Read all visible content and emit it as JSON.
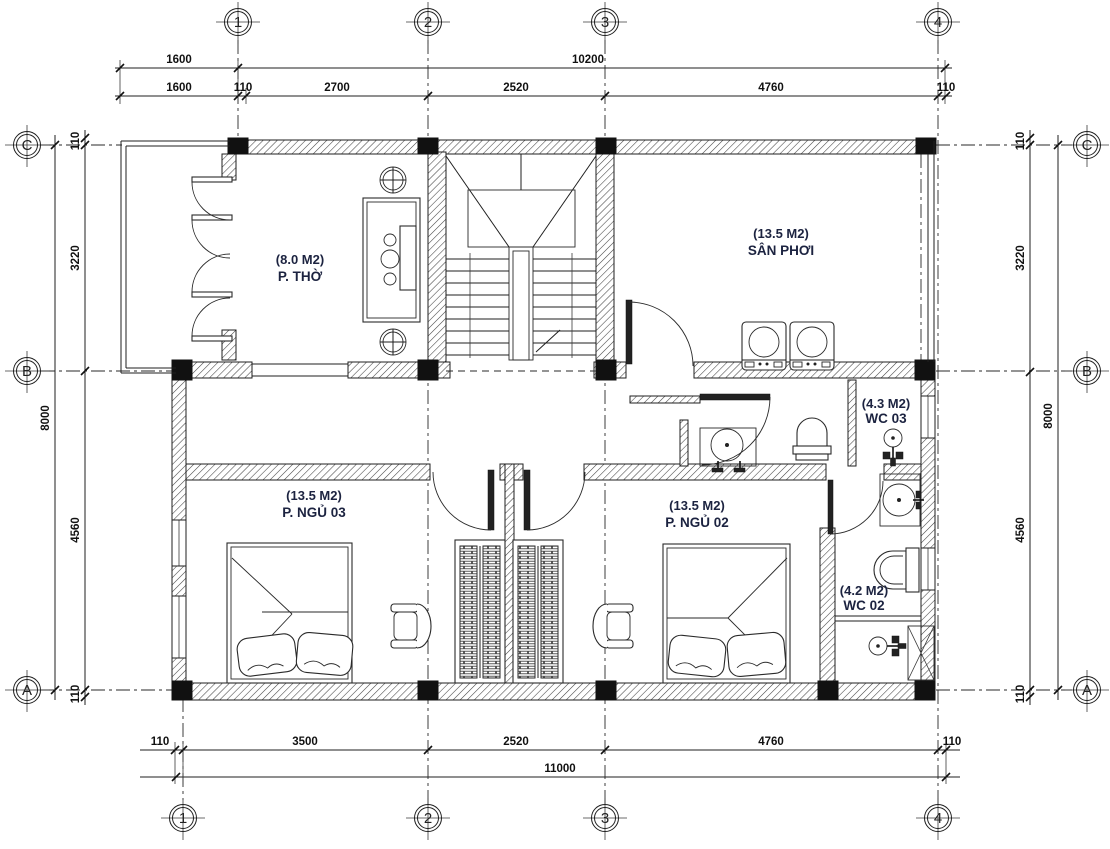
{
  "grid": {
    "top": [
      "1",
      "2",
      "3",
      "4"
    ],
    "bottom": [
      "1",
      "2",
      "3",
      "4"
    ],
    "left": [
      "C",
      "B",
      "A"
    ],
    "right": [
      "C",
      "B",
      "A"
    ]
  },
  "dims": {
    "top1": [
      "1600",
      "10200"
    ],
    "top2": [
      "1600",
      "110",
      "2700",
      "2520",
      "4760",
      "110"
    ],
    "bottom1": [
      "110",
      "3500",
      "2520",
      "4760",
      "110"
    ],
    "bottom2": [
      "11000"
    ],
    "left": [
      "110",
      "3220",
      "8000",
      "4560",
      "110"
    ],
    "right": [
      "110",
      "3220",
      "8000",
      "4560",
      "110"
    ]
  },
  "rooms": [
    {
      "area": "(8.0 M2)",
      "name": "P. THỜ"
    },
    {
      "area": "(13.5 M2)",
      "name": "SÂN PHƠI"
    },
    {
      "area": "(4.3 M2)",
      "name": "WC 03"
    },
    {
      "area": "(13.5 M2)",
      "name": "P. NGỦ 03"
    },
    {
      "area": "(13.5 M2)",
      "name": "P. NGỦ 02"
    },
    {
      "area": "(4.2 M2)",
      "name": "WC 02"
    }
  ],
  "colors": {
    "line": "#1f1f1f",
    "label": "#1c2340",
    "paper": "#ffffff"
  }
}
